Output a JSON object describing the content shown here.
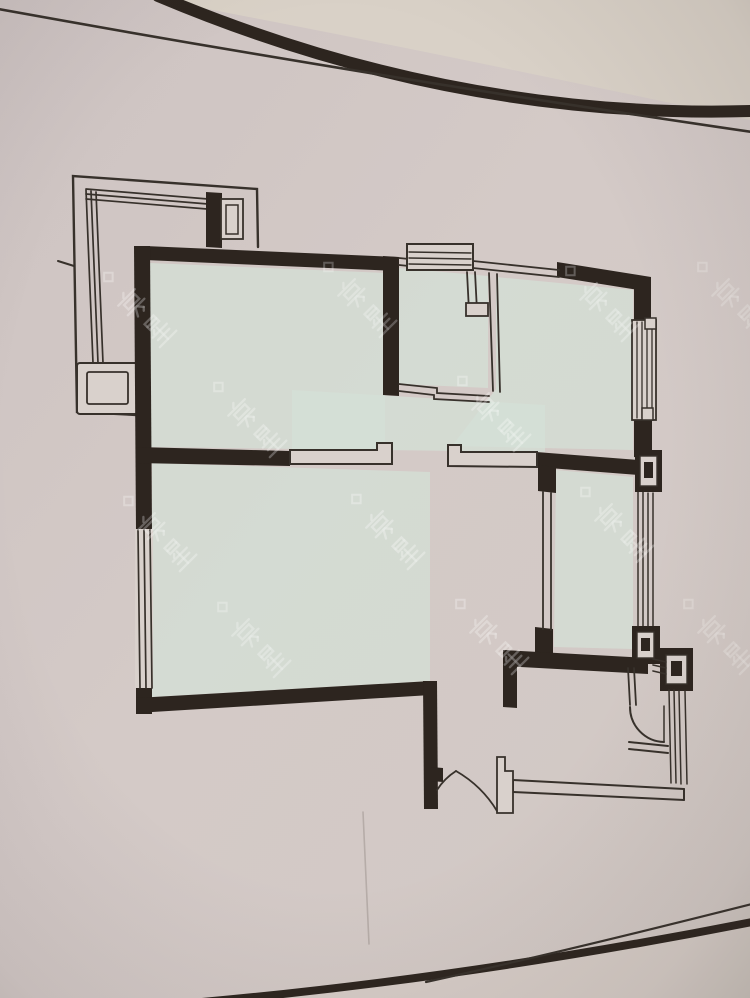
{
  "meta": {
    "label": "Photograph of an apartment floor-plan drawing (no text labels visible)",
    "width": 750,
    "height": 998
  },
  "colors": {
    "paper": "#d3c9c6",
    "paperL": "#dad3c6",
    "paperB": "#dad2cd",
    "wall": "#2c241e",
    "line": "#37302a",
    "floor": "#d6e2d8",
    "wm": "rgba(255,255,255,0.55)",
    "shade": "#d7cec7"
  },
  "watermark": {
    "text": "房星",
    "scale": 0.9,
    "stroke_w": 2.6,
    "diamond": "M1,-63 L7,-57 L1,-51 L-5,-57 Z",
    "glyphs": {
      "c1": [
        [
          "l",
          17,
          1,
          13,
          5
        ],
        [
          "l",
          3,
          7,
          29,
          7
        ],
        [
          "r",
          8,
          11,
          17,
          7
        ],
        [
          "l",
          3,
          22,
          29,
          22
        ],
        [
          "l",
          15,
          22,
          10,
          31
        ],
        [
          "l",
          17,
          22,
          22,
          28
        ],
        [
          "l",
          22,
          28,
          19,
          31
        ]
      ],
      "c2": [
        [
          "r",
          9,
          0,
          14,
          9
        ],
        [
          "l",
          9,
          4.5,
          23,
          4.5
        ],
        [
          "l",
          12,
          12,
          9,
          15
        ],
        [
          "l",
          5,
          17,
          27,
          17
        ],
        [
          "l",
          7,
          23,
          25,
          23
        ],
        [
          "l",
          3,
          30,
          29,
          30
        ],
        [
          "l",
          16,
          12,
          16,
          30
        ]
      ]
    },
    "positions": [
      [
        148,
        318,
        0.5
      ],
      [
        368,
        308,
        0.45
      ],
      [
        610,
        312,
        0.48
      ],
      [
        742,
        308,
        0.4
      ],
      [
        258,
        428,
        0.5
      ],
      [
        502,
        422,
        0.52
      ],
      [
        168,
        542,
        0.5
      ],
      [
        396,
        540,
        0.55
      ],
      [
        625,
        533,
        0.5
      ],
      [
        262,
        648,
        0.48
      ],
      [
        500,
        645,
        0.5
      ],
      [
        728,
        645,
        0.42
      ]
    ]
  },
  "vignette": {
    "k": "rect",
    "n": "photo-vignette",
    "r": [
      0,
      0,
      750,
      998
    ],
    "f": "url(#vig)"
  },
  "shapes": [
    {
      "k": "rect",
      "n": "paper-background",
      "r": [
        0,
        0,
        750,
        998
      ],
      "f": "url(#paperg)"
    },
    {
      "k": "path",
      "n": "paper-corner-light",
      "d": "M160,0 L750,0 L750,120 Q425,50 160,0 Z",
      "f": "paperL",
      "op": 0.9
    },
    {
      "k": "path",
      "n": "paper-bottom-corner",
      "d": "M202,998 Q468,978 752,922 L752,998 Z",
      "f": "shade",
      "op": 0.85
    },
    {
      "k": "poly",
      "n": "floor-master-bedroom",
      "p": "150,263 385,273 385,450 150,447",
      "f": "floor",
      "op": 0.72
    },
    {
      "k": "poly",
      "n": "floor-kitchen",
      "p": "399,268 488,276 488,388 399,384",
      "f": "floor",
      "op": 0.72
    },
    {
      "k": "poly",
      "n": "floor-bedroom-topright",
      "p": "496,277 633,290 633,450 452,446 496,389",
      "f": "floor",
      "op": 0.72
    },
    {
      "k": "poly",
      "n": "floor-hall",
      "p": "292,390 545,405 545,452 292,449",
      "f": "floor",
      "op": 0.72
    },
    {
      "k": "poly",
      "n": "floor-living-room",
      "p": "152,463 430,472 430,681 152,697",
      "f": "floor",
      "op": 0.72
    },
    {
      "k": "poly",
      "n": "floor-bedroom-right",
      "p": "556,470 633,477 633,649 554,647",
      "f": "floor",
      "op": 0.72
    },
    {
      "k": "path",
      "n": "photo-top-edge-thick",
      "d": "M158,-4 Q452,120 752,111",
      "s": "wall",
      "w": 12
    },
    {
      "k": "path",
      "n": "photo-top-edge-thin",
      "d": "M-2,9 Q368,76 752,132",
      "s": "line",
      "w": 2.6
    },
    {
      "k": "path",
      "n": "photo-bottom-edge-thick",
      "d": "M202,1002 Q468,978 752,922",
      "s": "wall",
      "w": 8
    },
    {
      "k": "path",
      "n": "photo-bottom-edge-thin",
      "d": "M426,982 Q562,952 752,904",
      "s": "line",
      "w": 2.2
    },
    {
      "k": "line",
      "n": "paper-crease",
      "l": [
        363,
        812,
        369,
        944
      ],
      "s": "rgba(115,104,99,0.3)",
      "w": 1.6
    },
    {
      "k": "path",
      "n": "balcony-outline",
      "d": "M258,247 L257,189 L73,176 L77,412 L137,415",
      "s": "line",
      "w": 2.4
    },
    {
      "k": "line",
      "n": "balcony-rail-top-1",
      "l": [
        86,
        189,
        208,
        199
      ],
      "s": "line",
      "w": 1.7
    },
    {
      "k": "line",
      "n": "balcony-rail-top-2",
      "l": [
        86,
        194,
        208,
        204
      ],
      "s": "line",
      "w": 1.7
    },
    {
      "k": "line",
      "n": "balcony-rail-top-3",
      "l": [
        86,
        199,
        207,
        209
      ],
      "s": "line",
      "w": 1.7
    },
    {
      "k": "line",
      "n": "balcony-rail-left-1",
      "l": [
        86,
        190,
        93,
        363
      ],
      "s": "line",
      "w": 1.7
    },
    {
      "k": "line",
      "n": "balcony-rail-left-2",
      "l": [
        91,
        191,
        98,
        363
      ],
      "s": "line",
      "w": 1.7
    },
    {
      "k": "line",
      "n": "balcony-rail-left-3",
      "l": [
        96,
        192,
        103,
        363
      ],
      "s": "line",
      "w": 1.7
    },
    {
      "k": "rect",
      "n": "balcony-planter-outer",
      "r": [
        77,
        363,
        61,
        51,
        3
      ],
      "f": "paperB",
      "s": "line",
      "w": 2
    },
    {
      "k": "rect",
      "n": "balcony-planter-inner",
      "r": [
        87,
        372,
        41,
        32,
        2
      ],
      "s": "line",
      "w": 1.8
    },
    {
      "k": "line",
      "n": "balcony-tick-mark",
      "l": [
        58,
        261,
        74,
        266
      ],
      "s": "line",
      "w": 2
    },
    {
      "k": "poly",
      "n": "wall-master-top",
      "p": "145,246 397,257 397,271 145,260",
      "f": "wall"
    },
    {
      "k": "poly",
      "n": "wall-master-left",
      "p": "134,246 150,246 152,531 136,531",
      "f": "wall"
    },
    {
      "k": "poly",
      "n": "wall-left-bottom-corner",
      "p": "136,686 152,686 152,714 136,714",
      "f": "wall"
    },
    {
      "k": "poly",
      "n": "wall-living-bottom",
      "p": "136,698 431,681 431,695 136,713",
      "f": "wall"
    },
    {
      "k": "poly",
      "n": "wall-living-right",
      "p": "423,681 437,681 438,809 424,809",
      "f": "wall"
    },
    {
      "k": "poly",
      "n": "wall-master-bottom",
      "p": "136,447 290,451 290,466 136,463",
      "f": "wall"
    },
    {
      "k": "poly",
      "n": "wall-kitchen-left",
      "p": "383,256 399,257 399,396 383,395",
      "f": "wall"
    },
    {
      "k": "poly",
      "n": "wall-topright-top",
      "p": "557,262 651,277 651,292 557,277",
      "f": "wall"
    },
    {
      "k": "poly",
      "n": "wall-right-upper",
      "p": "634,277 651,279 651,324 634,322",
      "f": "wall"
    },
    {
      "k": "poly",
      "n": "wall-right-mid",
      "p": "634,415 652,417 652,459 634,457",
      "f": "wall"
    },
    {
      "k": "poly",
      "n": "wall-hall-right",
      "p": "536,452 652,461 652,476 536,467",
      "f": "wall"
    },
    {
      "k": "poly",
      "n": "wall-bedroom2-stub-top",
      "p": "538,465 556,467 556,493 538,491",
      "f": "wall"
    },
    {
      "k": "poly",
      "n": "wall-bedroom2-stub-bottom",
      "p": "535,627 553,629 553,658 535,656",
      "f": "wall"
    },
    {
      "k": "poly",
      "n": "wall-bath-top",
      "p": "503,650 648,658 648,674 503,666",
      "f": "wall"
    },
    {
      "k": "poly",
      "n": "wall-bath-left-stub",
      "p": "503,650 517,651 517,708 503,707",
      "f": "wall"
    },
    {
      "k": "poly",
      "n": "wall-balcony-stub",
      "p": "206,192 222,193 222,248 206,247",
      "f": "wall"
    },
    {
      "k": "poly",
      "n": "wall-door-hinge-nub",
      "p": "431,767 443,768 443,782 431,781",
      "f": "wall"
    },
    {
      "k": "rect",
      "n": "balcony-stub-window",
      "r": [
        221,
        199,
        22,
        40
      ],
      "f": "paperB",
      "s": "line",
      "w": 1.8
    },
    {
      "k": "rect",
      "n": "balcony-stub-window-inner",
      "r": [
        226,
        205,
        12,
        29
      ],
      "s": "line",
      "w": 1.5
    },
    {
      "k": "line",
      "n": "kitchen-top-wall-a",
      "l": [
        399,
        258,
        409,
        259
      ],
      "s": "line",
      "w": 1.8
    },
    {
      "k": "line",
      "n": "kitchen-top-wall-b",
      "l": [
        399,
        265,
        409,
        266
      ],
      "s": "line",
      "w": 1.8
    },
    {
      "k": "line",
      "n": "kitchen-top-wall-c",
      "l": [
        473,
        261,
        559,
        270
      ],
      "s": "line",
      "w": 1.8
    },
    {
      "k": "line",
      "n": "kitchen-top-wall-d",
      "l": [
        473,
        268,
        559,
        277
      ],
      "s": "line",
      "w": 1.8
    },
    {
      "k": "line",
      "n": "kitchen-right-wall-a",
      "l": [
        489,
        273,
        493,
        391
      ],
      "s": "line",
      "w": 1.8
    },
    {
      "k": "line",
      "n": "kitchen-right-wall-b",
      "l": [
        497,
        274,
        500,
        392
      ],
      "s": "line",
      "w": 1.8
    },
    {
      "k": "path",
      "n": "kitchen-bottom-wall-a",
      "d": "M399,384 L437,388 L437,393 L489,396",
      "s": "line",
      "w": 1.8
    },
    {
      "k": "path",
      "n": "kitchen-bottom-wall-b",
      "d": "M399,391 L434,395 L434,399 L489,402",
      "s": "line",
      "w": 1.8
    },
    {
      "k": "line",
      "n": "kitchen-flue-a",
      "l": [
        467,
        272,
        469,
        311
      ],
      "s": "line",
      "w": 1.8
    },
    {
      "k": "line",
      "n": "kitchen-flue-b",
      "l": [
        475,
        272,
        477,
        311
      ],
      "s": "line",
      "w": 1.8
    },
    {
      "k": "rect",
      "n": "kitchen-flue-box",
      "r": [
        466,
        303,
        22,
        13
      ],
      "f": "paperB",
      "s": "line",
      "w": 1.8
    },
    {
      "k": "rect",
      "n": "kitchen-window-bump",
      "r": [
        407,
        244,
        66,
        26
      ],
      "f": "paperB",
      "s": "line",
      "w": 2
    },
    {
      "k": "line",
      "n": "kitchen-window-line-1",
      "l": [
        409,
        252,
        471,
        253
      ],
      "s": "line",
      "w": 1.4
    },
    {
      "k": "line",
      "n": "kitchen-window-line-2",
      "l": [
        409,
        258,
        471,
        259
      ],
      "s": "line",
      "w": 1.4
    },
    {
      "k": "line",
      "n": "kitchen-window-line-3",
      "l": [
        409,
        264,
        471,
        265
      ],
      "s": "line",
      "w": 1.4
    },
    {
      "k": "path",
      "n": "door-leaf-master",
      "d": "M290,450 L377,450 L377,443 L392,443 L392,464 L290,464 Z",
      "f": "paperB",
      "s": "line",
      "w": 2
    },
    {
      "k": "path",
      "n": "door-leaf-hall",
      "d": "M448,445 L461,445 L461,452 L537,452 L537,467 L448,466 Z",
      "f": "paperB",
      "s": "line",
      "w": 2
    },
    {
      "k": "rect",
      "n": "window-topright-frame",
      "r": [
        632,
        320,
        24,
        100
      ],
      "f": "paperB",
      "s": "line",
      "w": 1.8
    },
    {
      "k": "line",
      "n": "window-topright-line-1",
      "l": [
        637,
        322,
        637,
        418
      ],
      "s": "line",
      "w": 1.3
    },
    {
      "k": "line",
      "n": "window-topright-line-2",
      "l": [
        642,
        322,
        642,
        418
      ],
      "s": "line",
      "w": 1.3
    },
    {
      "k": "line",
      "n": "window-topright-line-3",
      "l": [
        647,
        323,
        647,
        419
      ],
      "s": "line",
      "w": 1.3
    },
    {
      "k": "line",
      "n": "window-topright-line-4",
      "l": [
        652,
        323,
        652,
        419
      ],
      "s": "line",
      "w": 1.3
    },
    {
      "k": "rect",
      "n": "window-topright-cap-top",
      "r": [
        645,
        318,
        11,
        11
      ],
      "f": "paperB",
      "s": "line",
      "w": 1.5
    },
    {
      "k": "rect",
      "n": "window-topright-cap-bottom",
      "r": [
        642,
        408,
        11,
        12
      ],
      "f": "paperB",
      "s": "line",
      "w": 1.5
    },
    {
      "k": "rect",
      "n": "window-left-frame",
      "r": [
        135,
        529,
        18,
        159
      ],
      "f": "paperB"
    },
    {
      "k": "line",
      "n": "window-left-line-1",
      "l": [
        138,
        530,
        140,
        688
      ],
      "s": "line",
      "w": 1.7
    },
    {
      "k": "line",
      "n": "window-left-line-2",
      "l": [
        144,
        530,
        146,
        688
      ],
      "s": "line",
      "w": 1.7
    },
    {
      "k": "line",
      "n": "window-left-line-3",
      "l": [
        150,
        530,
        152,
        688
      ],
      "s": "line",
      "w": 1.7
    },
    {
      "k": "line",
      "n": "bedroom2-left-wall-a",
      "l": [
        543,
        492,
        543,
        629
      ],
      "s": "line",
      "w": 1.8
    },
    {
      "k": "line",
      "n": "bedroom2-left-wall-b",
      "l": [
        551,
        493,
        551,
        630
      ],
      "s": "line",
      "w": 1.8
    },
    {
      "k": "line",
      "n": "window-bedroom2-line-1",
      "l": [
        638,
        492,
        638,
        629
      ],
      "s": "line",
      "w": 1.5
    },
    {
      "k": "line",
      "n": "window-bedroom2-line-2",
      "l": [
        643,
        492,
        643,
        629
      ],
      "s": "line",
      "w": 1.5
    },
    {
      "k": "line",
      "n": "window-bedroom2-line-3",
      "l": [
        648,
        493,
        648,
        630
      ],
      "s": "line",
      "w": 1.5
    },
    {
      "k": "line",
      "n": "window-bedroom2-line-4",
      "l": [
        653,
        493,
        653,
        630
      ],
      "s": "line",
      "w": 1.5
    },
    {
      "k": "rect",
      "n": "column-1-outer",
      "r": [
        635,
        450,
        27,
        42
      ],
      "f": "wall"
    },
    {
      "k": "rect",
      "n": "column-1-mid",
      "r": [
        640,
        456,
        17,
        30
      ],
      "f": "paperB",
      "s": "line",
      "w": 1.4
    },
    {
      "k": "rect",
      "n": "column-1-core",
      "r": [
        644,
        462,
        9,
        16
      ],
      "f": "wall"
    },
    {
      "k": "rect",
      "n": "column-2-outer",
      "r": [
        632,
        626,
        28,
        38
      ],
      "f": "wall"
    },
    {
      "k": "rect",
      "n": "column-2-mid",
      "r": [
        637,
        632,
        17,
        26
      ],
      "f": "paperB",
      "s": "line",
      "w": 1.4
    },
    {
      "k": "rect",
      "n": "column-2-core",
      "r": [
        641,
        638,
        9,
        13
      ],
      "f": "wall"
    },
    {
      "k": "rect",
      "n": "column-3-outer",
      "r": [
        660,
        648,
        33,
        43
      ],
      "f": "wall"
    },
    {
      "k": "rect",
      "n": "column-3-mid",
      "r": [
        666,
        655,
        21,
        29
      ],
      "f": "paperB",
      "s": "line",
      "w": 1.4
    },
    {
      "k": "rect",
      "n": "column-3-core",
      "r": [
        671,
        661,
        11,
        15
      ],
      "f": "wall"
    },
    {
      "k": "line",
      "n": "wall-hatch-1",
      "l": [
        653,
        659,
        666,
        662
      ],
      "s": "line",
      "w": 1.6
    },
    {
      "k": "line",
      "n": "wall-hatch-2",
      "l": [
        653,
        665,
        666,
        668
      ],
      "s": "line",
      "w": 1.6
    },
    {
      "k": "line",
      "n": "wall-hatch-3",
      "l": [
        653,
        671,
        666,
        674
      ],
      "s": "line",
      "w": 1.6
    },
    {
      "k": "line",
      "n": "bath-stub-wall-a",
      "l": [
        628,
        668,
        630,
        705
      ],
      "s": "line",
      "w": 1.8
    },
    {
      "k": "line",
      "n": "bath-stub-wall-b",
      "l": [
        634,
        668,
        636,
        705
      ],
      "s": "line",
      "w": 1.8
    },
    {
      "k": "path",
      "n": "bath-door-arc",
      "d": "M630,707 A35 35 0 0 0 664,742",
      "s": "line",
      "w": 2
    },
    {
      "k": "line",
      "n": "bath-door-leaf",
      "l": [
        664,
        706,
        664,
        742
      ],
      "s": "line",
      "w": 1.5
    },
    {
      "k": "line",
      "n": "bath-threshold-a",
      "l": [
        629,
        742,
        668,
        746
      ],
      "s": "line",
      "w": 2
    },
    {
      "k": "line",
      "n": "bath-threshold-b",
      "l": [
        629,
        749,
        668,
        753
      ],
      "s": "line",
      "w": 2
    },
    {
      "k": "line",
      "n": "window-bath-line-1",
      "l": [
        669,
        690,
        671,
        783
      ],
      "s": "line",
      "w": 1.5
    },
    {
      "k": "line",
      "n": "window-bath-line-2",
      "l": [
        674,
        690,
        676,
        783
      ],
      "s": "line",
      "w": 1.5
    },
    {
      "k": "line",
      "n": "window-bath-line-3",
      "l": [
        679,
        691,
        681,
        784
      ],
      "s": "line",
      "w": 1.5
    },
    {
      "k": "line",
      "n": "window-bath-line-4",
      "l": [
        685,
        691,
        687,
        784
      ],
      "s": "line",
      "w": 1.5
    },
    {
      "k": "path",
      "n": "bath-bottom-wall-a",
      "d": "M513,780 L684,789",
      "s": "line",
      "w": 2
    },
    {
      "k": "path",
      "n": "bath-bottom-wall-b",
      "d": "M513,792 L684,800",
      "s": "line",
      "w": 2
    },
    {
      "k": "line",
      "n": "bath-bottom-end-left",
      "l": [
        513,
        780,
        513,
        792
      ],
      "s": "line",
      "w": 2
    },
    {
      "k": "line",
      "n": "bath-bottom-end-right",
      "l": [
        684,
        789,
        684,
        800
      ],
      "s": "line",
      "w": 2
    },
    {
      "k": "path",
      "n": "entry-door-jamb",
      "d": "M497,757 L505,757 L505,771 L513,771 L513,813 L497,813 Z",
      "f": "paperB",
      "s": "line",
      "w": 1.8
    },
    {
      "k": "path",
      "n": "entry-door-arc",
      "d": "M437,790 A62 62 0 0 1 456,771",
      "s": "line",
      "w": 1.8
    },
    {
      "k": "path",
      "n": "entry-door-leaf",
      "d": "M456,771 Q482,786 497,811",
      "s": "line",
      "w": 1.8
    }
  ]
}
